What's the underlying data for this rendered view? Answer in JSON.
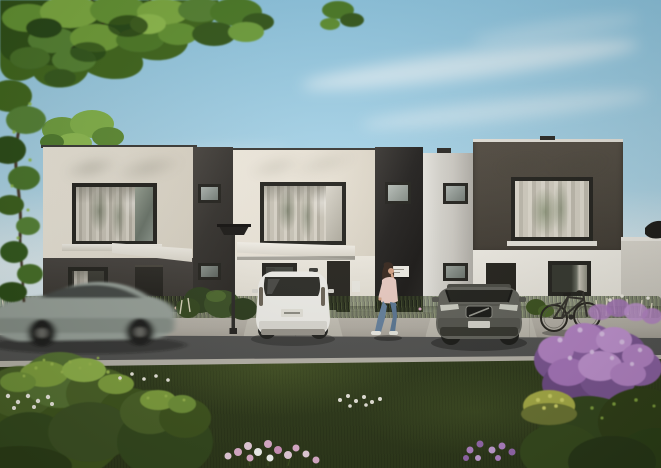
{
  "meta": {
    "title": "Architectural rendering - modern townhouse row at street level",
    "canvas": {
      "width": 661,
      "height": 468
    },
    "visible_text": []
  },
  "scene": {
    "setting": "sunny day, exterior visualization of three attached two-story modern houses with flat roofs",
    "elements": [
      {
        "name": "sky",
        "description": "clear blue sky with thin wispy clouds"
      },
      {
        "name": "tree-canopy",
        "description": "green tree branches overhanging the top-left corner"
      },
      {
        "name": "left-tree",
        "description": "tall leafy tree at the far left edge"
      },
      {
        "name": "townhouse-left",
        "description": "cream upper floor, charcoal ground floor, large picture window with curtains, dark entry door under white canopy"
      },
      {
        "name": "townhouse-middle",
        "description": "cream facade with large window, white ground floor, dark entry door, glossy black divider strips"
      },
      {
        "name": "townhouse-right",
        "description": "dark charcoal upper block with large curtained window, white ground floor with dark door and window"
      },
      {
        "name": "street-lamp",
        "description": "modern dark flat-top street lamp in front of the houses"
      },
      {
        "name": "moving-car",
        "description": "motion-blurred grey-green sedan driving along the road to the left"
      },
      {
        "name": "white-suv",
        "description": "white compact SUV parked in a driveway, seen from the rear"
      },
      {
        "name": "grey-suv",
        "description": "grey SUV parked in the right driveway, seen from the front"
      },
      {
        "name": "pedestrian",
        "description": "woman with dark hair, pink top, blue jeans and white shoes walking on the sidewalk holding a phone"
      },
      {
        "name": "bicycle",
        "description": "dark city bicycle leaning against the white wall under the right ground-floor window"
      },
      {
        "name": "front-garden",
        "description": "foreground lawn with large green shrubs, purple flowering bushes, yellow bush, pink, purple and white flower clusters"
      },
      {
        "name": "flower-bed",
        "description": "strip of wild grasses and small white and pink flowers along the house fronts"
      },
      {
        "name": "conifers",
        "description": "two small conifer trees by the pale garden wall at the right"
      }
    ]
  },
  "palette": {
    "sky_top": "#8fc7e3",
    "sky_mid": "#abd5e9",
    "sky_horizon": "#dcebf1",
    "facade_cream": "#e7e1d5",
    "facade_dark": "#3d3935",
    "facade_glossy_black": "#232120",
    "facade_brown_dark": "#4a443c",
    "facade_white": "#e8e4db",
    "facade_grey_tower": "#cfccc6",
    "window_frame": "#24231f",
    "sidewalk": "#b3aea5",
    "road": "#575757",
    "curb": "#b9b5ac",
    "lawn": "#36431f",
    "shrub_highlight": "#9ab84d",
    "flowers_purple": "#b583c7",
    "flowers_pink": "#e7b5d6",
    "flowers_white": "#efece3",
    "car_blur": "#99a29b",
    "suv_white": "#f0efeb",
    "suv_grey": "#62625c",
    "person_top": "#eccdc5",
    "person_jeans": "#64809e"
  }
}
